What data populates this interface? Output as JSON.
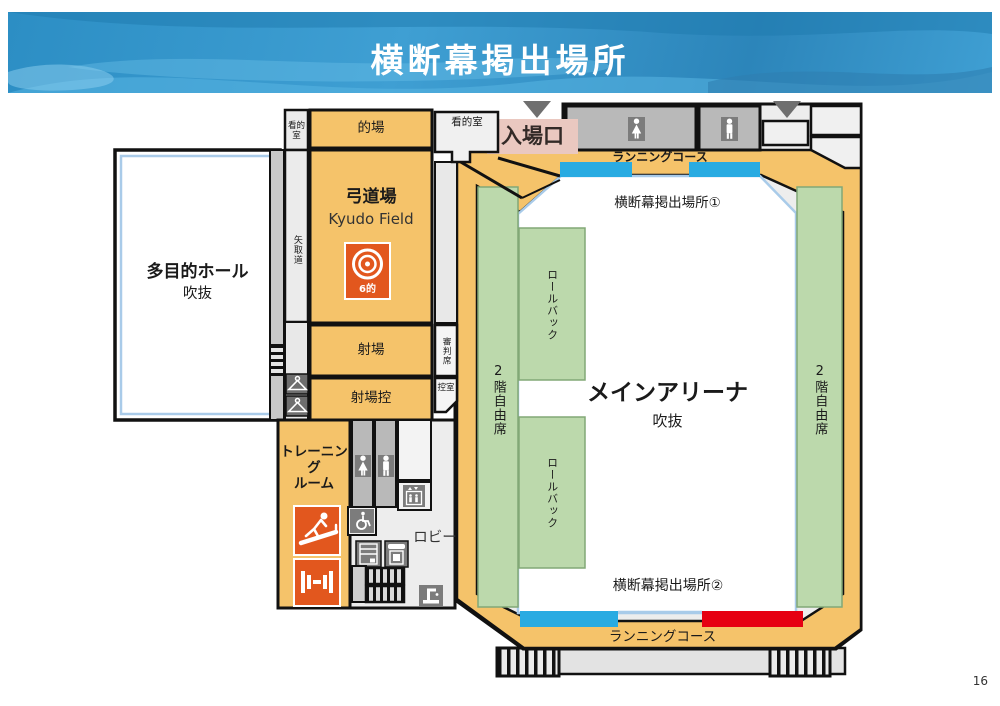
{
  "page": {
    "number": "16"
  },
  "header": {
    "title": "横断幕掲出場所"
  },
  "colors": {
    "header_blue": "#2e8fc6",
    "room_orange": "#f5c36a",
    "accent_orange": "#e2571e",
    "seat_green": "#bcd9ac",
    "banner_blue": "#29abe2",
    "banner_red": "#e60012",
    "wall_lightblue": "#a9cbe9",
    "entrance_pink": "#eac8c0"
  },
  "plan": {
    "entrance": {
      "label": "入場口"
    },
    "kyudo": {
      "kantekishitsu_left": "看的室",
      "matoba": "的場",
      "name_jp": "弓道場",
      "name_en": "Kyudo Field",
      "targets": "6的",
      "yatorimichi": "矢取道",
      "kantekishitsu_right": "看的室",
      "shajo": "射場",
      "shinpanseki": "審判席",
      "shajo_hikae": "射場控",
      "hikaeshitsu": "控室"
    },
    "hall": {
      "name": "多目的ホール",
      "note": "吹抜"
    },
    "lobby_block": {
      "training_room": "トレーニング\nルーム",
      "lobby": "ロビー"
    },
    "arena": {
      "name": "メインアリーナ",
      "note": "吹抜",
      "banner_spot_1": "横断幕掲出場所①",
      "banner_spot_2": "横断幕掲出場所②",
      "running_course_top": "ランニングコース",
      "running_course_bottom": "ランニングコース",
      "seats_left": "2階自由席",
      "seats_right": "2階自由席",
      "rollback_upper": "ロールバック",
      "rollback_lower": "ロールバック"
    }
  },
  "icons": {
    "entrance_arrow": "triangle-down",
    "womens_restroom": "female-figure",
    "mens_restroom": "male-figure",
    "elevator": "elevator-figures-arrows",
    "wheelchair_access": "wheelchair",
    "vending_machine": "vending-machine",
    "public_phone": "public-phone",
    "drinking_fountain": "drinking-fountain",
    "stairs": "stair-hatch",
    "coat_hanger": "hanger",
    "treadmill": "running-machine",
    "dumbbell": "free-weights",
    "kyudo_target": "archery-target"
  }
}
